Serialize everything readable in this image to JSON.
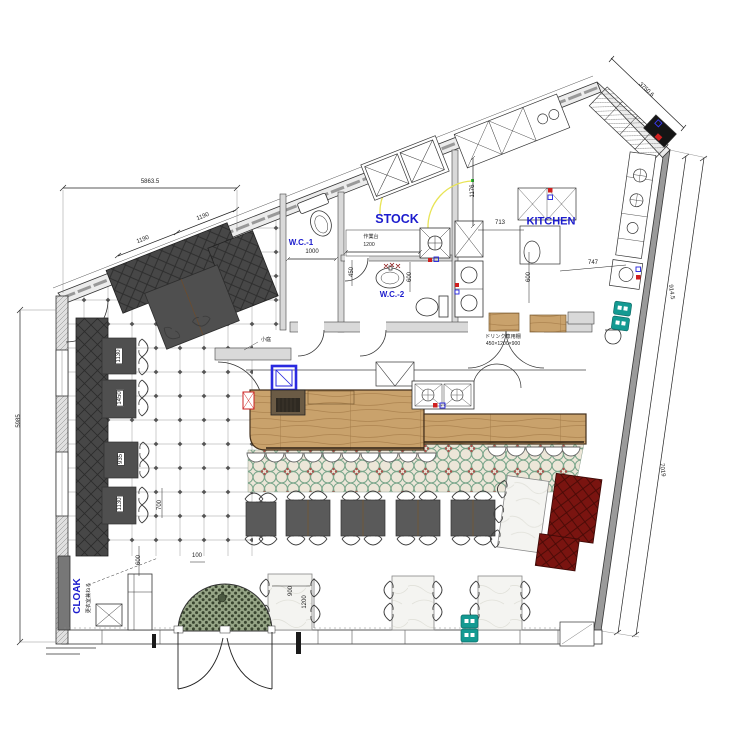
{
  "title": "restaurant-floor-plan",
  "rooms": {
    "wc1": "W.C.-1",
    "wc2": "W.C.-2",
    "stock": "STOCK",
    "kitchen": "KITCHEN",
    "cloak": "CLOAK",
    "cloak_note": "更衣室兼ねる",
    "garden": "小庭"
  },
  "fixtures": {
    "work_counter": "作業台",
    "drink_shelf": "ドリンク専用棚",
    "drink_shelf_size": "450×1200×900"
  },
  "dimensions": {
    "top_overall": "5863.5",
    "top_seg_a": "1190",
    "top_seg_b": "1190",
    "top_right_wall": "3750.6",
    "right_upper": "914.5",
    "right_wall": "7019",
    "left_wall": "5985",
    "wc1_width": "1000",
    "work_counter_width": "1200",
    "wc2_depth": "450",
    "wc2_width": "600",
    "stock_kitchen": "1176",
    "kitchen_left": "713",
    "kitchen_right": "747",
    "kitchen_depth": "600",
    "cloak_width": "600",
    "entry_offset": "100",
    "table_width": "900",
    "table_length": "1200",
    "bench_gap": "700"
  },
  "table_labels": [
    "1130",
    "1450",
    "935",
    "1130"
  ],
  "colors": {
    "label_blue": "#1c1ccd",
    "wood": "#c9a26c",
    "bench_dark": "#474747",
    "bench_red": "#7a1410",
    "tile_green": "#79a58a",
    "tile_red": "#b0514d",
    "outlet_teal": "#149a92",
    "highlight_blue": "#2a2ae0",
    "swing_yellow": "#e8e455"
  }
}
